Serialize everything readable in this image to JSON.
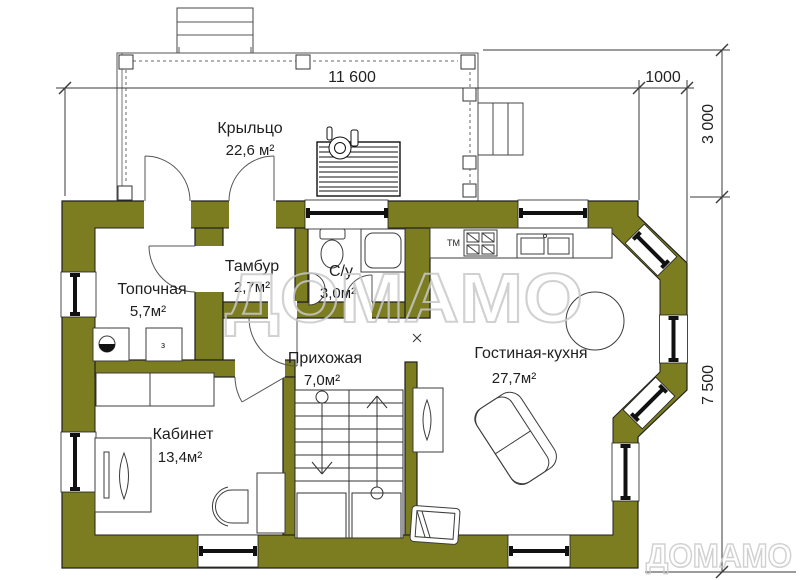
{
  "plan": {
    "type": "floor-plan",
    "wall_color": "#7c7c20",
    "line_color": "#1f1f1f",
    "watermark_color": "#c9c9c9"
  },
  "rooms": [
    {
      "id": "porch",
      "name": "Крыльцо",
      "area": "22,6 м²"
    },
    {
      "id": "boiler",
      "name": "Топочная",
      "area": "5,7м²"
    },
    {
      "id": "tambour",
      "name": "Тамбур",
      "area": "2,7м²"
    },
    {
      "id": "bathroom",
      "name": "С/у",
      "area": "3,0м²"
    },
    {
      "id": "hallway",
      "name": "Прихожая",
      "area": "7,0м²"
    },
    {
      "id": "study",
      "name": "Кабинет",
      "area": "13,4м²"
    },
    {
      "id": "living",
      "name": "Гостиная-кухня",
      "area": "27,7м²"
    }
  ],
  "dimensions": {
    "total_width": "11 600",
    "bay_depth": "1000",
    "porch_depth": "3 000",
    "house_depth": "7 500"
  },
  "annotations": {
    "tm_label": "ТМ",
    "boiler_unit": "з"
  },
  "watermark": {
    "center": "ДОМАМО",
    "corner": "ДОМАМО"
  }
}
